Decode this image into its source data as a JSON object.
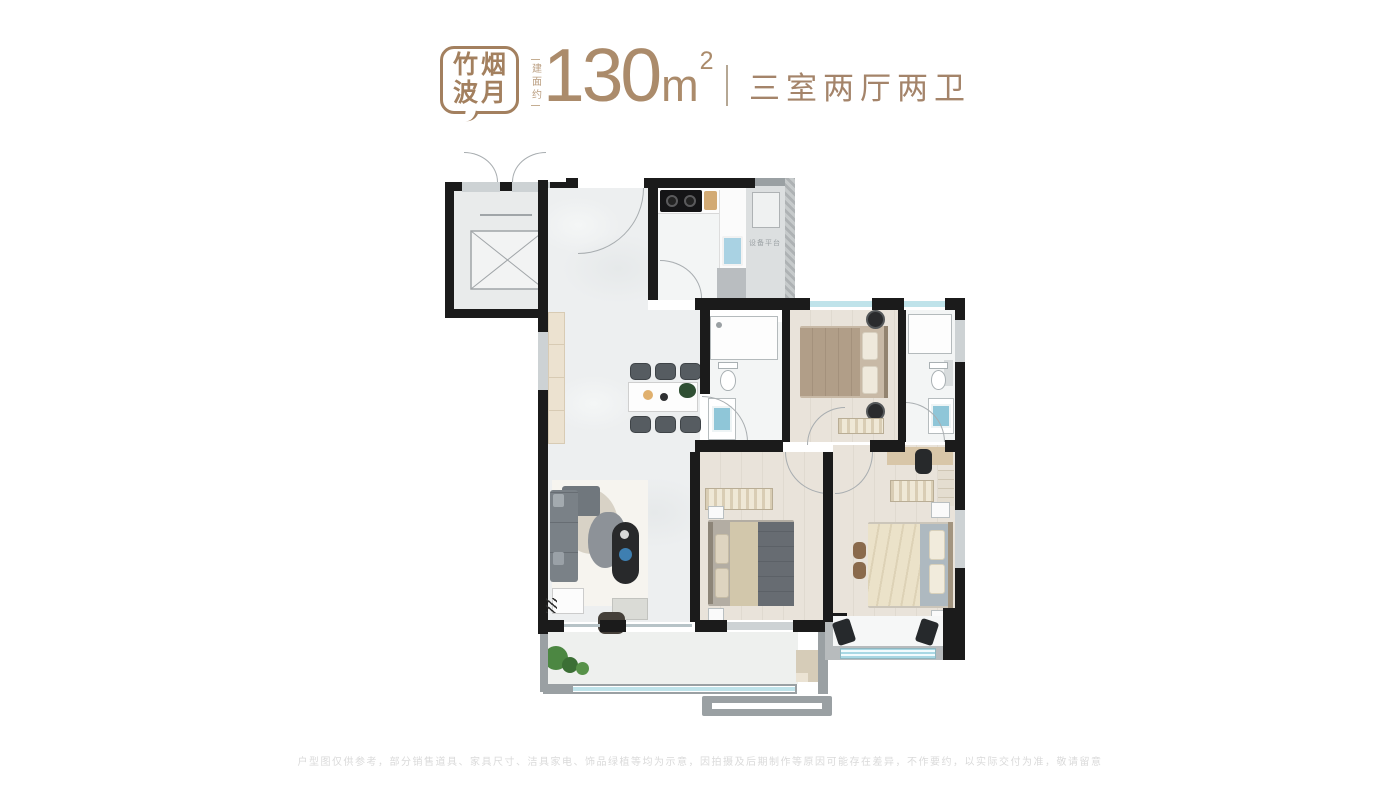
{
  "header": {
    "badge": {
      "line1": "竹烟",
      "line2": "波月"
    },
    "area": {
      "prefix": "建面约",
      "value": "130",
      "unit": "m",
      "exponent": "2"
    },
    "layout_label": "三室两厅两卫"
  },
  "plan": {
    "equipment_platform_label": "设备平台"
  },
  "footer": {
    "disclaimer": "户型图仅供参考，部分销售道具、家具尺寸、洁具家电、饰品绿植等均为示意，因拍摄及后期制作等原因可能存在差异，不作要约，以实际交付为准，敬请留意"
  },
  "colors": {
    "accent_bronze": "#a4846a",
    "wall_black": "#1b1b1b",
    "window_blue": "#bfe3ea"
  }
}
